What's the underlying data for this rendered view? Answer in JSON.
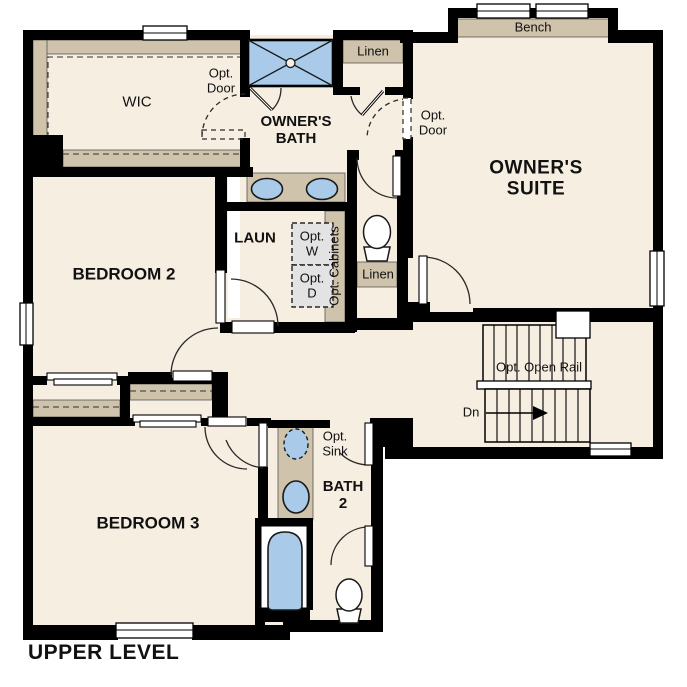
{
  "plan": {
    "title": "UPPER LEVEL",
    "labels": {
      "wic": "WIC",
      "opt_door": [
        "Opt.",
        "Door"
      ],
      "owners_bath": [
        "OWNER'S",
        "BATH"
      ],
      "owners_suite": [
        "OWNER'S",
        "SUITE"
      ],
      "bench": "Bench",
      "linen_upper": "Linen",
      "linen_hall": "Linen",
      "laundry": "LAUN",
      "opt_washer": [
        "Opt.",
        "W"
      ],
      "opt_dryer": [
        "Opt.",
        "D"
      ],
      "opt_cabinets": "Opt. Cabinets",
      "bedroom2": "BEDROOM 2",
      "bedroom3": "BEDROOM 3",
      "opt_open_rail": "Opt. Open Rail",
      "down": "Dn",
      "opt_sink": [
        "Opt.",
        "Sink"
      ],
      "bath2": [
        "BATH",
        "2"
      ]
    },
    "colors": {
      "floor": "#f6eee1",
      "wall": "#000000",
      "millwork": "#cfc3ab",
      "fixture": "#a9cbe9",
      "optional": "#e3e3e3",
      "outline": "#1a1a1a",
      "bg": "#ffffff"
    }
  }
}
